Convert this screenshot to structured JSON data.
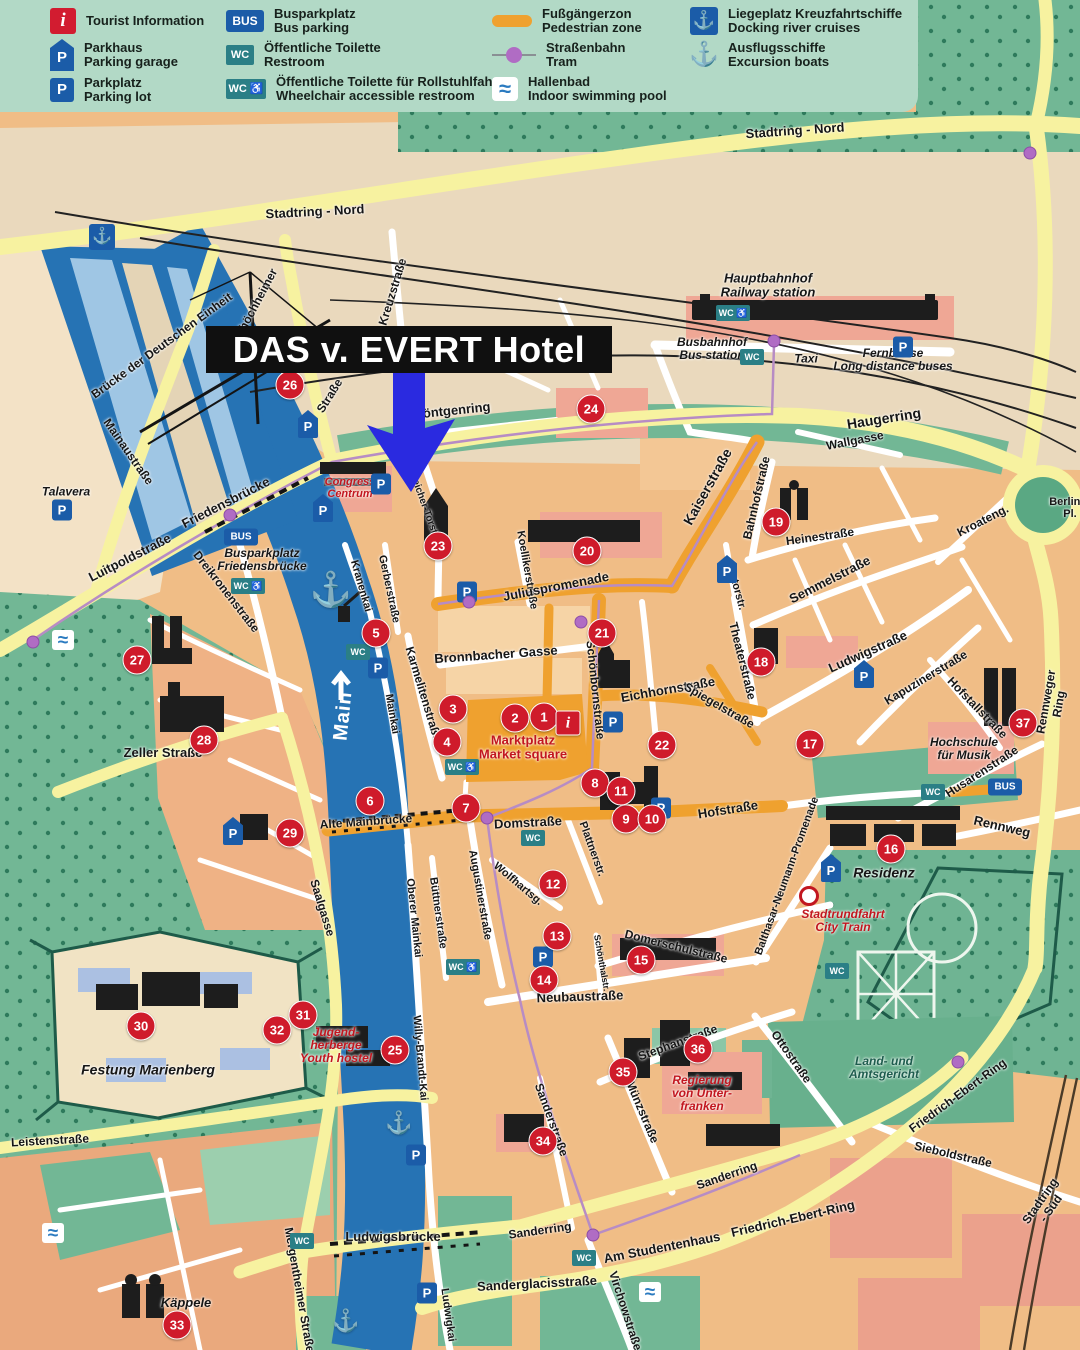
{
  "legend": {
    "items": [
      {
        "icon": "info",
        "glyph": "i",
        "de": "Tourist Information",
        "en": ""
      },
      {
        "icon": "p-shield",
        "glyph": "P",
        "de": "Parkhaus",
        "en": "Parking garage"
      },
      {
        "icon": "p-square",
        "glyph": "P",
        "de": "Parkplatz",
        "en": "Parking lot"
      },
      {
        "icon": "bus",
        "glyph": "BUS",
        "de": "Busparkplatz",
        "en": "Bus parking"
      },
      {
        "icon": "wc",
        "glyph": "WC",
        "de": "Öffentliche Toilette",
        "en": "Restroom"
      },
      {
        "icon": "wc-access",
        "glyph": "WC ♿",
        "de": "Öffentliche Toilette für Rollstuhlfahrer",
        "en": "Wheelchair accessible restroom"
      },
      {
        "icon": "pedzone",
        "glyph": "",
        "de": "Fußgängerzon",
        "en": "Pedestrian zone"
      },
      {
        "icon": "tram",
        "glyph": "",
        "de": "Straßenbahn",
        "en": "Tram"
      },
      {
        "icon": "pool",
        "glyph": "≈",
        "de": "Hallenbad",
        "en": "Indoor swimming pool"
      },
      {
        "icon": "anchor-badge",
        "glyph": "⚓",
        "de": "Liegeplatz Kreuzfahrtschiffe",
        "en": "Docking river cruises"
      },
      {
        "icon": "anchor",
        "glyph": "⚓",
        "de": "Ausflugsschiffe",
        "en": "Excursion boats"
      }
    ]
  },
  "hotel": {
    "label": "DAS v. EVERT Hotel"
  },
  "colors": {
    "arrow_blue": "#2a2ae0",
    "marker_red": "#cf1b2b",
    "parking_blue": "#1b5ca8",
    "wc_teal": "#2b7f86",
    "pedzone_orange": "#efa12f",
    "river_blue": "#2673b4",
    "road_yellow": "#f7f2a0",
    "park_green": "#72b795",
    "legend_bg": "#b2d9c6"
  },
  "map": {
    "badge_glyphs": {
      "P": "P",
      "PS": "P",
      "BUS": "BUS",
      "WC": "WC",
      "WCA": "WC ♿",
      "ANB": "⚓",
      "ANW": "⚓",
      "SWIM": "≈",
      "TD": "",
      "CT": ""
    },
    "street_labels": [
      {
        "t": "Stadtring - Nord",
        "x": 315,
        "y": 212,
        "r": -3,
        "s": 13
      },
      {
        "t": "Stadtring - Nord",
        "x": 795,
        "y": 131,
        "r": -4,
        "s": 13
      },
      {
        "t": "Hauptbahnhof\nRailway station",
        "x": 768,
        "y": 286,
        "r": 0,
        "s": 13,
        "c": "it"
      },
      {
        "t": "Busbahnhof\nBus station",
        "x": 712,
        "y": 349,
        "r": 0,
        "s": 12,
        "c": "it"
      },
      {
        "t": "Taxi",
        "x": 806,
        "y": 359,
        "r": 0,
        "s": 12,
        "c": "it"
      },
      {
        "t": "Fernbusse\nLong distance buses",
        "x": 893,
        "y": 360,
        "r": 0,
        "s": 12,
        "c": "it"
      },
      {
        "t": "Haugerring",
        "x": 884,
        "y": 419,
        "r": -9,
        "s": 14
      },
      {
        "t": "Wallgasse",
        "x": 855,
        "y": 441,
        "r": -11,
        "s": 12
      },
      {
        "t": "Bahnhofstraße",
        "x": 757,
        "y": 498,
        "r": -77,
        "s": 12
      },
      {
        "t": "Heinestraße",
        "x": 820,
        "y": 537,
        "r": -8,
        "s": 12
      },
      {
        "t": "Kroateng.",
        "x": 983,
        "y": 521,
        "r": -27,
        "s": 12
      },
      {
        "t": "Kaiserstraße",
        "x": 708,
        "y": 487,
        "r": -61,
        "s": 14
      },
      {
        "t": "Kreuzstraße",
        "x": 393,
        "y": 292,
        "r": -73,
        "s": 12
      },
      {
        "t": "Veitshöchheimer",
        "x": 252,
        "y": 312,
        "r": -62,
        "s": 12
      },
      {
        "t": "Straße",
        "x": 330,
        "y": 396,
        "r": -58,
        "s": 12
      },
      {
        "t": "Brücke der Deutschen Einheit",
        "x": 162,
        "y": 346,
        "r": -36,
        "s": 12
      },
      {
        "t": "Mainaustraße",
        "x": 128,
        "y": 452,
        "r": 55,
        "s": 12
      },
      {
        "t": "Talavera",
        "x": 66,
        "y": 492,
        "r": 0,
        "s": 12,
        "c": "it"
      },
      {
        "t": "Friedensbrücke",
        "x": 226,
        "y": 503,
        "r": -27,
        "s": 13
      },
      {
        "t": "Luitpoldstraße",
        "x": 130,
        "y": 558,
        "r": -27,
        "s": 13
      },
      {
        "t": "Dreikronenstraße",
        "x": 226,
        "y": 592,
        "r": 52,
        "s": 12
      },
      {
        "t": "Busparkplatz\nFriedensbrücke",
        "x": 262,
        "y": 560,
        "r": 0,
        "s": 12,
        "c": "it"
      },
      {
        "t": "Zeller Straße",
        "x": 163,
        "y": 753,
        "r": 0,
        "s": 13
      },
      {
        "t": "Main",
        "x": 343,
        "y": 716,
        "r": -84,
        "s": 20,
        "c": "wht"
      },
      {
        "t": "Kranenkai",
        "x": 361,
        "y": 586,
        "r": 74,
        "s": 11
      },
      {
        "t": "Gerberstraße",
        "x": 389,
        "y": 589,
        "r": 78,
        "s": 11
      },
      {
        "t": "Koellikerstraße",
        "x": 527,
        "y": 570,
        "r": 80,
        "s": 11
      },
      {
        "t": "Juliuspromenade",
        "x": 556,
        "y": 587,
        "r": -11,
        "s": 13
      },
      {
        "t": "Congress\nCentrum",
        "x": 350,
        "y": 488,
        "r": 0,
        "s": 11,
        "c": "red"
      },
      {
        "t": "Röntgenring",
        "x": 452,
        "y": 411,
        "r": -6,
        "s": 13
      },
      {
        "t": "Pleicher-Torstr.",
        "x": 424,
        "y": 505,
        "r": 70,
        "s": 10
      },
      {
        "t": "Karmelitenstraße",
        "x": 423,
        "y": 694,
        "r": 73,
        "s": 12
      },
      {
        "t": "Mainkai",
        "x": 392,
        "y": 714,
        "r": 80,
        "s": 11
      },
      {
        "t": "Bronnbacher Gasse",
        "x": 496,
        "y": 655,
        "r": -4,
        "s": 13
      },
      {
        "t": "Schönbornstraße",
        "x": 595,
        "y": 690,
        "r": 84,
        "s": 12
      },
      {
        "t": "Marktplatz\nMarket square",
        "x": 523,
        "y": 748,
        "r": 0,
        "s": 13,
        "c": "redb"
      },
      {
        "t": "Eichhornstraße",
        "x": 668,
        "y": 690,
        "r": -10,
        "s": 13
      },
      {
        "t": "Spiegelstraße",
        "x": 719,
        "y": 706,
        "r": 30,
        "s": 12
      },
      {
        "t": "Theaterstraße",
        "x": 742,
        "y": 661,
        "r": 76,
        "s": 12
      },
      {
        "t": "Textorstr.",
        "x": 736,
        "y": 586,
        "r": 75,
        "s": 11
      },
      {
        "t": "Semmelstraße",
        "x": 830,
        "y": 580,
        "r": -27,
        "s": 13
      },
      {
        "t": "Ludwigstraße",
        "x": 868,
        "y": 652,
        "r": -24,
        "s": 13
      },
      {
        "t": "Kapuzinerstraße",
        "x": 926,
        "y": 678,
        "r": -31,
        "s": 12
      },
      {
        "t": "Hofstallstraße",
        "x": 977,
        "y": 708,
        "r": 46,
        "s": 12
      },
      {
        "t": "Hochschule\nfür Musik",
        "x": 964,
        "y": 749,
        "r": 0,
        "s": 12,
        "c": "it"
      },
      {
        "t": "Husarenstraße",
        "x": 982,
        "y": 772,
        "r": -33,
        "s": 12
      },
      {
        "t": "Rennweger Ring",
        "x": 1053,
        "y": 703,
        "r": -80,
        "s": 12
      },
      {
        "t": "Berliner Pl.",
        "x": 1070,
        "y": 508,
        "r": 0,
        "s": 11
      },
      {
        "t": "Hofstraße",
        "x": 728,
        "y": 810,
        "r": -9,
        "s": 13
      },
      {
        "t": "Rennweg",
        "x": 1002,
        "y": 827,
        "r": 13,
        "s": 13
      },
      {
        "t": "Residenz",
        "x": 884,
        "y": 873,
        "r": 0,
        "s": 14,
        "c": "it"
      },
      {
        "t": "Stadtrundfahrt\nCity Train",
        "x": 843,
        "y": 921,
        "r": 0,
        "s": 12,
        "c": "red"
      },
      {
        "t": "Balthasar-Neumann-Promenade",
        "x": 787,
        "y": 876,
        "r": -70,
        "s": 11
      },
      {
        "t": "Domstraße",
        "x": 528,
        "y": 823,
        "r": -3,
        "s": 13
      },
      {
        "t": "Alte Mainbrücke",
        "x": 366,
        "y": 822,
        "r": -4,
        "s": 12
      },
      {
        "t": "Plattnerstr.",
        "x": 592,
        "y": 849,
        "r": 70,
        "s": 11
      },
      {
        "t": "Wolfhartsg.",
        "x": 518,
        "y": 884,
        "r": 40,
        "s": 11
      },
      {
        "t": "Augustinerstraße",
        "x": 480,
        "y": 895,
        "r": 80,
        "s": 11
      },
      {
        "t": "Büttnerstraße",
        "x": 438,
        "y": 913,
        "r": 82,
        "s": 11
      },
      {
        "t": "Oberer Mainkai",
        "x": 414,
        "y": 918,
        "r": 84,
        "s": 11
      },
      {
        "t": "Saalgasse",
        "x": 322,
        "y": 908,
        "r": 73,
        "s": 12
      },
      {
        "t": "Schönthalstr.",
        "x": 601,
        "y": 963,
        "r": 80,
        "s": 9
      },
      {
        "t": "Domerschulstraße",
        "x": 676,
        "y": 947,
        "r": 14,
        "s": 12
      },
      {
        "t": "Neubaustraße",
        "x": 580,
        "y": 997,
        "r": -2,
        "s": 13
      },
      {
        "t": "Stephanstraße",
        "x": 678,
        "y": 1043,
        "r": -20,
        "s": 12
      },
      {
        "t": "Münzstraße",
        "x": 642,
        "y": 1112,
        "r": 67,
        "s": 12
      },
      {
        "t": "Sanderstraße",
        "x": 551,
        "y": 1120,
        "r": 70,
        "s": 12
      },
      {
        "t": "Ottostraße",
        "x": 791,
        "y": 1057,
        "r": 55,
        "s": 12
      },
      {
        "t": "Regierung\nvon Unter-\nfranken",
        "x": 702,
        "y": 1094,
        "r": 0,
        "s": 12,
        "c": "red"
      },
      {
        "t": "Land- und\nAmtsgericht",
        "x": 884,
        "y": 1068,
        "r": 0,
        "s": 12,
        "c": "grn"
      },
      {
        "t": "Friedrich-Ebert-Ring",
        "x": 958,
        "y": 1096,
        "r": -36,
        "s": 12
      },
      {
        "t": "Sieboldstraße",
        "x": 953,
        "y": 1155,
        "r": 13,
        "s": 12
      },
      {
        "t": "Sanderring",
        "x": 727,
        "y": 1176,
        "r": -19,
        "s": 12
      },
      {
        "t": "Sanderring",
        "x": 540,
        "y": 1231,
        "r": -8,
        "s": 12
      },
      {
        "t": "Am Studentenhaus",
        "x": 662,
        "y": 1248,
        "r": -11,
        "s": 13
      },
      {
        "t": "Friedrich-Ebert-Ring",
        "x": 793,
        "y": 1219,
        "r": -13,
        "s": 13
      },
      {
        "t": "Sanderglacisstraße",
        "x": 537,
        "y": 1284,
        "r": -3,
        "s": 13
      },
      {
        "t": "Virchowstraße",
        "x": 625,
        "y": 1311,
        "r": 72,
        "s": 12
      },
      {
        "t": "Ludwigsbrücke",
        "x": 393,
        "y": 1237,
        "r": 0,
        "s": 13
      },
      {
        "t": "Ludwigkai",
        "x": 448,
        "y": 1315,
        "r": 82,
        "s": 11
      },
      {
        "t": "Willy-Brandt-Kai",
        "x": 420,
        "y": 1058,
        "r": 85,
        "s": 11
      },
      {
        "t": "Mergentheimer Straße",
        "x": 299,
        "y": 1290,
        "r": 80,
        "s": 12
      },
      {
        "t": "Leistenstraße",
        "x": 50,
        "y": 1141,
        "r": -3,
        "s": 12
      },
      {
        "t": "Festung Marienberg",
        "x": 148,
        "y": 1070,
        "r": 0,
        "s": 14,
        "c": "it"
      },
      {
        "t": "Jugend-\nherberge\nYouth hostel",
        "x": 336,
        "y": 1046,
        "r": 0,
        "s": 12,
        "c": "red"
      },
      {
        "t": "Käppele",
        "x": 186,
        "y": 1303,
        "r": 0,
        "s": 13,
        "c": "it"
      },
      {
        "t": "Stadtring - Süd",
        "x": 1046,
        "y": 1205,
        "r": -55,
        "s": 12
      }
    ],
    "markers": [
      {
        "n": "1",
        "x": 544,
        "y": 717
      },
      {
        "n": "2",
        "x": 515,
        "y": 718
      },
      {
        "n": "3",
        "x": 453,
        "y": 709
      },
      {
        "n": "4",
        "x": 447,
        "y": 742
      },
      {
        "n": "5",
        "x": 376,
        "y": 633
      },
      {
        "n": "6",
        "x": 370,
        "y": 801
      },
      {
        "n": "7",
        "x": 466,
        "y": 808
      },
      {
        "n": "8",
        "x": 595,
        "y": 783
      },
      {
        "n": "9",
        "x": 626,
        "y": 819
      },
      {
        "n": "10",
        "x": 652,
        "y": 819
      },
      {
        "n": "11",
        "x": 621,
        "y": 791
      },
      {
        "n": "12",
        "x": 553,
        "y": 884
      },
      {
        "n": "13",
        "x": 557,
        "y": 936
      },
      {
        "n": "14",
        "x": 544,
        "y": 980
      },
      {
        "n": "15",
        "x": 641,
        "y": 960
      },
      {
        "n": "16",
        "x": 891,
        "y": 849
      },
      {
        "n": "17",
        "x": 810,
        "y": 744
      },
      {
        "n": "18",
        "x": 761,
        "y": 662
      },
      {
        "n": "19",
        "x": 776,
        "y": 522
      },
      {
        "n": "20",
        "x": 587,
        "y": 551
      },
      {
        "n": "21",
        "x": 602,
        "y": 633
      },
      {
        "n": "22",
        "x": 662,
        "y": 745
      },
      {
        "n": "23",
        "x": 438,
        "y": 546
      },
      {
        "n": "24",
        "x": 591,
        "y": 409
      },
      {
        "n": "25",
        "x": 395,
        "y": 1050
      },
      {
        "n": "26",
        "x": 290,
        "y": 385
      },
      {
        "n": "27",
        "x": 137,
        "y": 660
      },
      {
        "n": "28",
        "x": 204,
        "y": 740
      },
      {
        "n": "29",
        "x": 290,
        "y": 833
      },
      {
        "n": "30",
        "x": 141,
        "y": 1026
      },
      {
        "n": "31",
        "x": 303,
        "y": 1015
      },
      {
        "n": "32",
        "x": 277,
        "y": 1030
      },
      {
        "n": "33",
        "x": 177,
        "y": 1325
      },
      {
        "n": "34",
        "x": 543,
        "y": 1141
      },
      {
        "n": "35",
        "x": 623,
        "y": 1072
      },
      {
        "n": "36",
        "x": 698,
        "y": 1049
      },
      {
        "n": "37",
        "x": 1023,
        "y": 723
      },
      {
        "n": "i",
        "x": 568,
        "y": 723
      }
    ],
    "badges": [
      {
        "t": "PS",
        "x": 308,
        "y": 424
      },
      {
        "t": "P",
        "x": 381,
        "y": 484
      },
      {
        "t": "P",
        "x": 62,
        "y": 510
      },
      {
        "t": "PS",
        "x": 323,
        "y": 508
      },
      {
        "t": "P",
        "x": 378,
        "y": 668
      },
      {
        "t": "P",
        "x": 467,
        "y": 592
      },
      {
        "t": "PS",
        "x": 727,
        "y": 569
      },
      {
        "t": "P",
        "x": 903,
        "y": 347
      },
      {
        "t": "PS",
        "x": 864,
        "y": 674
      },
      {
        "t": "P",
        "x": 661,
        "y": 808
      },
      {
        "t": "PS",
        "x": 831,
        "y": 868
      },
      {
        "t": "P",
        "x": 543,
        "y": 957
      },
      {
        "t": "PS",
        "x": 233,
        "y": 831
      },
      {
        "t": "P",
        "x": 416,
        "y": 1155
      },
      {
        "t": "P",
        "x": 427,
        "y": 1293
      },
      {
        "t": "P",
        "x": 613,
        "y": 722
      },
      {
        "t": "BUS",
        "x": 241,
        "y": 537
      },
      {
        "t": "BUS",
        "x": 1005,
        "y": 787
      },
      {
        "t": "WCA",
        "x": 248,
        "y": 586
      },
      {
        "t": "WC",
        "x": 358,
        "y": 652
      },
      {
        "t": "WCA",
        "x": 462,
        "y": 767
      },
      {
        "t": "WC",
        "x": 533,
        "y": 838
      },
      {
        "t": "WCA",
        "x": 463,
        "y": 967
      },
      {
        "t": "WC",
        "x": 837,
        "y": 971
      },
      {
        "t": "WC",
        "x": 933,
        "y": 792
      },
      {
        "t": "WC",
        "x": 584,
        "y": 1258
      },
      {
        "t": "WCA",
        "x": 733,
        "y": 313
      },
      {
        "t": "WC",
        "x": 752,
        "y": 357
      },
      {
        "t": "WC",
        "x": 302,
        "y": 1241
      },
      {
        "t": "ANB",
        "x": 102,
        "y": 237
      },
      {
        "t": "ANW",
        "x": 331,
        "y": 590,
        "s": 34
      },
      {
        "t": "ANW",
        "x": 399,
        "y": 1123,
        "s": 22
      },
      {
        "t": "ANW",
        "x": 346,
        "y": 1321,
        "s": 22
      },
      {
        "t": "SWIM",
        "x": 63,
        "y": 640
      },
      {
        "t": "SWIM",
        "x": 53,
        "y": 1233
      },
      {
        "t": "SWIM",
        "x": 650,
        "y": 1292
      },
      {
        "t": "TD",
        "x": 33,
        "y": 642
      },
      {
        "t": "TD",
        "x": 230,
        "y": 515
      },
      {
        "t": "TD",
        "x": 469,
        "y": 602
      },
      {
        "t": "TD",
        "x": 581,
        "y": 622
      },
      {
        "t": "TD",
        "x": 487,
        "y": 818
      },
      {
        "t": "TD",
        "x": 593,
        "y": 1235
      },
      {
        "t": "TD",
        "x": 774,
        "y": 341
      },
      {
        "t": "TD",
        "x": 958,
        "y": 1062
      },
      {
        "t": "TD",
        "x": 1030,
        "y": 153
      },
      {
        "t": "CT",
        "x": 809,
        "y": 896
      }
    ]
  }
}
